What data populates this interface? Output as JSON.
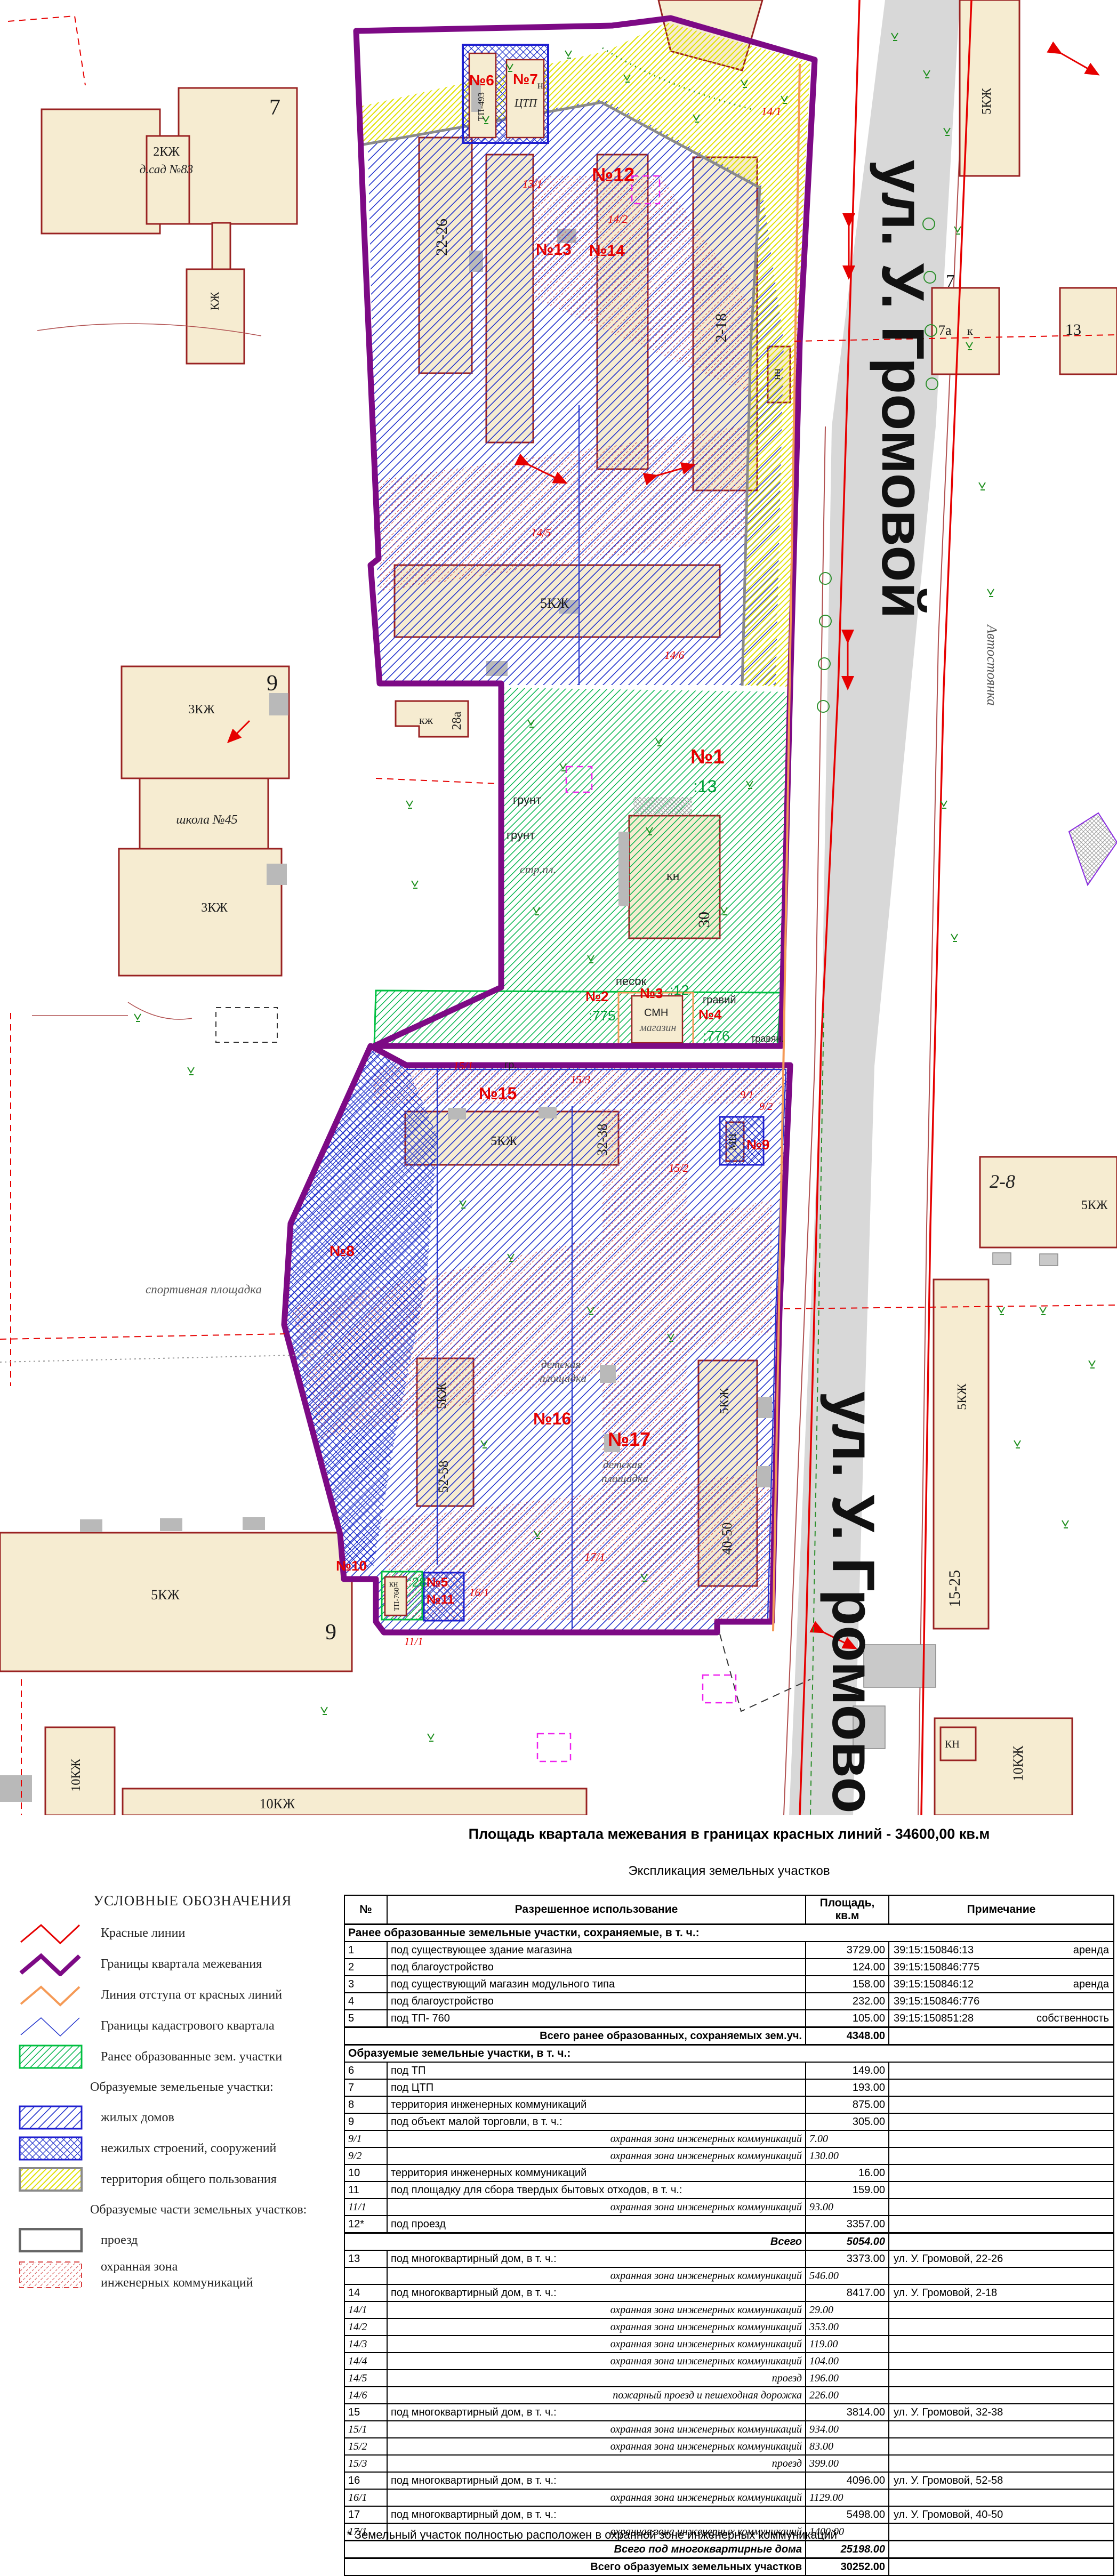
{
  "map": {
    "labels": {
      "street": "ул. У. Громовой",
      "n1": "№1",
      "n2": "№2",
      "n3": "№3",
      "n4": "№4",
      "n5": "№5",
      "n6": "№6",
      "n7": "№7",
      "n8": "№8",
      "n9": "№9",
      "n10": "№10",
      "n11": "№11",
      "n12": "№12",
      "n13": "№13",
      "n14": "№14",
      "n15": "№15",
      "n16": "№16",
      "n17": "№17",
      "s13_1": "13/1",
      "s14_1": "14/1",
      "s14_2": "14/2",
      "s14_5": "14/5",
      "s14_6": "14/6",
      "s15_1": "15/1",
      "s15_2": "15/2",
      "s15_3": "15/3",
      "s16_1": "16/1",
      "s17_1": "17/1",
      "s9_1": "9/1",
      "s9_2": "9/2",
      "s11_1": "11/1",
      "cad13": ":13",
      "cad775": ":775",
      "cad12": ":12",
      "cad776": ":776",
      "cad28": ":28",
      "kzh2": "2КЖ",
      "dsad": "д.сад №83",
      "seven": "7",
      "kzh": "КЖ",
      "nine": "9",
      "kzh3": "3КЖ",
      "school": "школа №45",
      "b2226": "22-26",
      "b218": "2-18",
      "b3238": "32-38",
      "b5258": "52-58",
      "b4050": "40-50",
      "b1525": "15-25",
      "b28": "2-8",
      "kzh5": "5КЖ",
      "kzh10": "10КЖ",
      "b28a": "28а",
      "kzh_s": "кж",
      "nn": "нн",
      "kn": "кн",
      "kn2": "КН",
      "thirty": "30",
      "tp493": "ТП-493",
      "ctp": "ЦТП",
      "n_s": "н",
      "smn": "СМН",
      "magazin": "магазин",
      "mn": "МН",
      "tp760": "ТП-760",
      "b7a": "7а",
      "k_s": "к",
      "b13": "13",
      "avtost": "Автостоянка",
      "sport": "спортивная площадка",
      "det1": "детская",
      "det2": "площадка",
      "grunt": "грунт",
      "pesok": "песок",
      "graviy": "гравий",
      "gr": "гр.",
      "travyan": "травян.",
      "strpl": "стр.пл."
    }
  },
  "legend": {
    "title": "УСЛОВНЫЕ ОБОЗНАЧЕНИЯ",
    "items": [
      {
        "label": "Красные линии"
      },
      {
        "label": "Границы квартала межевания"
      },
      {
        "label": "Линия отступа от красных линий"
      },
      {
        "label": "Границы кадастрового квартала"
      },
      {
        "label": "Ранее образованные зем. участки"
      },
      {
        "label": "Образуемые земельеные участки:"
      },
      {
        "label": "жилых домов"
      },
      {
        "label": "нежилых строений, сооружений"
      },
      {
        "label": "территория общего пользования"
      },
      {
        "label": "Образуемые части земельных участков:"
      },
      {
        "label": "проезд"
      },
      {
        "label": "охранная зона",
        "label2": "инженерных коммуникаций"
      }
    ]
  },
  "summary": {
    "title": "Площадь квартала межевания в границах красных линий - 34600,00 кв.м",
    "subtitle": "Экспликация земельных участков"
  },
  "table": {
    "headers": [
      "№",
      "Разрешенное использование",
      "Площадь, кв.м",
      "Примечание"
    ],
    "rows": [
      {
        "style": "sec",
        "use": "Ранее образованные земельные участки, сохраняемые, в т. ч.:"
      },
      {
        "num": "1",
        "use": "под существующее здание магазина",
        "area": "3729.00",
        "note": "39:15:150846:13",
        "note2": "аренда"
      },
      {
        "num": "2",
        "use": "под благоустройство",
        "area": "124.00",
        "note": "39:15:150846:775"
      },
      {
        "num": "3",
        "use": "под существующий магазин модульного типа",
        "area": "158.00",
        "note": "39:15:150846:12",
        "note2": "аренда"
      },
      {
        "num": "4",
        "use": "под благоустройство",
        "area": "232.00",
        "note": "39:15:150846:776"
      },
      {
        "num": "5",
        "use": "под ТП- 760",
        "area": "105.00",
        "note": "39:15:150851:28",
        "note2": "собственность"
      },
      {
        "style": "total",
        "use": "Всего ранее образованных, сохраняемых зем.уч.",
        "area": "4348.00"
      },
      {
        "style": "sec",
        "use": "Образуемые земельные участки, в т. ч.:"
      },
      {
        "num": "6",
        "use": "под ТП",
        "area": "149.00"
      },
      {
        "num": "7",
        "use": "под ЦТП",
        "area": "193.00"
      },
      {
        "num": "8",
        "use": "территория инженерных коммуникаций",
        "area": "875.00"
      },
      {
        "num": "9",
        "use": "под объект малой торговли, в т. ч.:",
        "area": "305.00"
      },
      {
        "style": "sub",
        "num": "9/1",
        "use": "охранная зона инженерных коммуникаций",
        "area": "7.00"
      },
      {
        "style": "sub",
        "num": "9/2",
        "use": "охранная зона инженерных коммуникаций",
        "area": "130.00"
      },
      {
        "num": "10",
        "use": "территория инженерных коммуникаций",
        "area": "16.00"
      },
      {
        "num": "11",
        "use": "под площадку для сбора твердых бытовых отходов, в т. ч.:",
        "area": "159.00"
      },
      {
        "style": "sub",
        "num": "11/1",
        "use": "охранная зона инженерных коммуникаций",
        "area": "93.00"
      },
      {
        "num": "12*",
        "use": "под проезд",
        "area": "3357.00"
      },
      {
        "style": "totali",
        "use": "Всего",
        "area": "5054.00"
      },
      {
        "num": "13",
        "use": "под многоквартирный дом, в т. ч.:",
        "area": "3373.00",
        "note": "ул. У. Громовой, 22-26"
      },
      {
        "style": "sub",
        "num": "",
        "use": "охранная зона инженерных коммуникаций",
        "area": "546.00"
      },
      {
        "num": "14",
        "use": "под многоквартирный дом, в т. ч.:",
        "area": "8417.00",
        "note": "ул. У. Громовой, 2-18"
      },
      {
        "style": "sub",
        "num": "14/1",
        "use": "охранная зона инженерных коммуникаций",
        "area": "29.00"
      },
      {
        "style": "sub",
        "num": "14/2",
        "use": "охранная зона инженерных коммуникаций",
        "area": "353.00"
      },
      {
        "style": "sub",
        "num": "14/3",
        "use": "охранная зона инженерных коммуникаций",
        "area": "119.00"
      },
      {
        "style": "sub",
        "num": "14/4",
        "use": "охранная зона инженерных коммуникаций",
        "area": "104.00"
      },
      {
        "style": "sub",
        "num": "14/5",
        "use": "проезд",
        "area": "196.00"
      },
      {
        "style": "sub",
        "num": "14/6",
        "use": "пожарный проезд и пешеходная дорожка",
        "area": "226.00"
      },
      {
        "num": "15",
        "use": "под многоквартирный дом, в т. ч.:",
        "area": "3814.00",
        "note": "ул. У. Громовой, 32-38"
      },
      {
        "style": "sub",
        "num": "15/1",
        "use": "охранная зона инженерных коммуникаций",
        "area": "934.00"
      },
      {
        "style": "sub",
        "num": "15/2",
        "use": "охранная зона инженерных коммуникаций",
        "area": "83.00"
      },
      {
        "style": "sub",
        "num": "15/3",
        "use": "проезд",
        "area": "399.00"
      },
      {
        "num": "16",
        "use": "под многоквартирный дом, в т. ч.:",
        "area": "4096.00",
        "note": "ул. У. Громовой, 52-58"
      },
      {
        "style": "sub",
        "num": "16/1",
        "use": "охранная зона инженерных коммуникаций",
        "area": "1129.00"
      },
      {
        "num": "17",
        "use": "под многоквартирный дом, в т. ч.:",
        "area": "5498.00",
        "note": "ул. У. Громовой, 40-50"
      },
      {
        "style": "sub",
        "num": "17/1",
        "use": "охранная зона инженерных коммуникаций",
        "area": "1400.00"
      },
      {
        "style": "totali",
        "use": "Всего под многоквартирные дома",
        "area": "25198.00"
      },
      {
        "style": "total",
        "use": "Всего образуемых земельных участков",
        "area": "30252.00"
      }
    ]
  },
  "footnote": "* Земельный участок полностью расположен в охранной зоне инженерных коммуникаций",
  "colors": {
    "quarter_boundary": "#7d0a85",
    "red_line": "#e60000",
    "setback_line": "#f59a56",
    "cadastral_line": "#2233cc",
    "building_fill": "#f6ecd1",
    "building_stroke": "#992222",
    "street_fill": "#d8d8d8",
    "prior_parcel": "#00b34a",
    "common_area": "#e0e000"
  }
}
